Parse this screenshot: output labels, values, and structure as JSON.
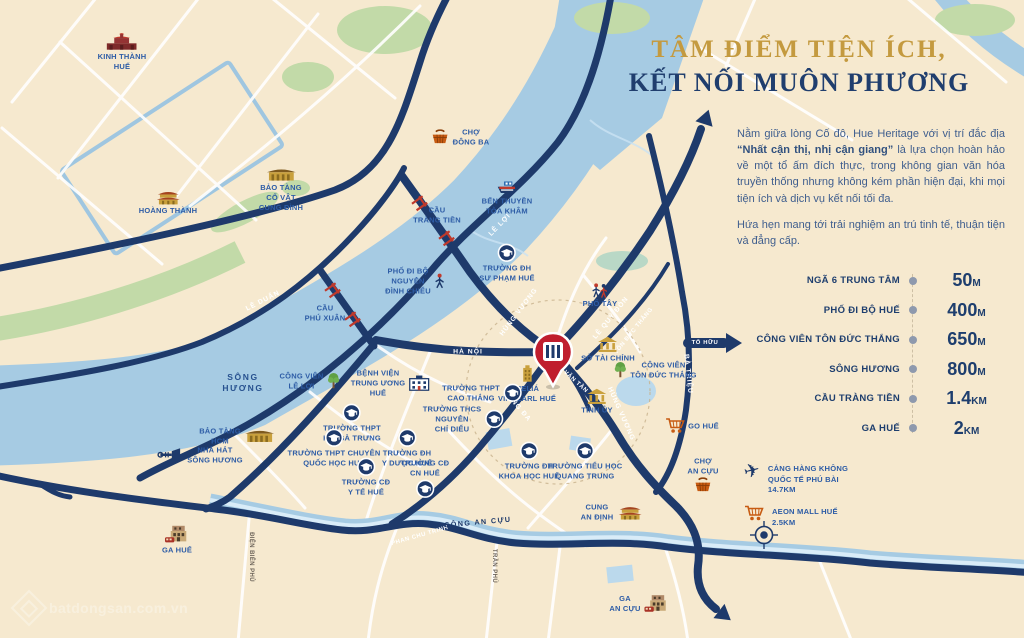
{
  "colors": {
    "background": "#F6E9CF",
    "navy": "#1E3A6B",
    "gold": "#C49A3F",
    "poi_blue": "#2D5CA6",
    "river_blue": "#A6CBE3",
    "green": "#C2DAA8",
    "pin_red": "#C01E2E",
    "orange": "#C75B12"
  },
  "header": {
    "line1": "TÂM ĐIỂM TIỆN ÍCH,",
    "line2": "KẾT NỐI MUÔN PHƯƠNG"
  },
  "intro": {
    "p1_pre": "Nằm giữa lòng Cố đô, Hue Heritage với vị trí đắc địa ",
    "p1_bold": "“Nhất cận thị, nhị cận giang”",
    "p1_post": " là lựa chọn hoàn hảo về một tổ ấm đích thực, trong không gian văn hóa truyền thống nhưng không kém phần hiện đại, khi mọi tiện ích và dịch vụ kết nối tối đa.",
    "p2": "Hứa hẹn mang tới trải nghiệm an trú tinh tế, thuận tiện và đẳng cấp."
  },
  "distances": [
    {
      "label": "NGÃ 6 TRUNG TÂM",
      "value": "50",
      "unit": "M"
    },
    {
      "label": "PHỐ ĐI BỘ HUẾ",
      "value": "400",
      "unit": "M"
    },
    {
      "label": "CÔNG VIÊN TÔN ĐỨC THẮNG",
      "value": "650",
      "unit": "M"
    },
    {
      "label": "SÔNG HƯƠNG",
      "value": "800",
      "unit": "M"
    },
    {
      "label": "CẦU TRÀNG TIỀN",
      "value": "1.4",
      "unit": "KM"
    },
    {
      "label": "GA HUẾ",
      "value": "2",
      "unit": "KM"
    }
  ],
  "legend": [
    {
      "icon": "plane-icon",
      "text": "CẢNG HÀNG KHÔNG\nQUỐC TẾ PHÚ BÀI\n14.7KM"
    },
    {
      "icon": "cart-icon",
      "text": "AEON MALL HUẾ\n2.5KM"
    }
  ],
  "map": {
    "pin": {
      "x": 553,
      "y": 395
    },
    "pois": [
      {
        "id": "kinh-thanh-hue",
        "label": "KINH THÀNH\nHUẾ",
        "icon": "citadel-gate-icon",
        "x": 122,
        "y": 52,
        "side": "top"
      },
      {
        "id": "hoang-thanh",
        "label": "HOÀNG THÀNH",
        "icon": "palace-icon",
        "x": 168,
        "y": 202,
        "side": "top"
      },
      {
        "id": "bao-tang-co-vat-cung-dinh",
        "label": "BẢO TÀNG\nCỔ VẬT\nCUNG ĐÌNH",
        "icon": "museum-icon",
        "x": 281,
        "y": 190,
        "side": "top"
      },
      {
        "id": "cho-dong-ba",
        "label": "CHỢ\nĐÔNG BA",
        "icon": "market-basket-icon",
        "x": 460,
        "y": 137,
        "side": "left"
      },
      {
        "id": "ben-thuyen-toa-kham",
        "label": "BẾN THUYỀN\nTÒA KHÂM",
        "icon": "boat-icon",
        "x": 507,
        "y": 198,
        "side": "top"
      },
      {
        "id": "cau-trang-tien",
        "label": "CẦU\nTRÀNG TIỀN",
        "icon": "",
        "x": 437,
        "y": 215,
        "side": "top"
      },
      {
        "id": "pho-di-bo-nguyen-dinh-chieu",
        "label": "PHỐ ĐI BỘ\nNGUYỄN\nĐÌNH CHIỂU",
        "icon": "walking-person-icon",
        "x": 415,
        "y": 281,
        "side": "right"
      },
      {
        "id": "truong-dh-su-pham-hue",
        "label": "TRƯỜNG ĐH\nSƯ PHẠM HUẾ",
        "icon": "school-icon",
        "x": 507,
        "y": 263,
        "side": "top"
      },
      {
        "id": "pho-tay",
        "label": "PHỐ TÂY",
        "icon": "walking-people-icon",
        "x": 600,
        "y": 296,
        "side": "top"
      },
      {
        "id": "cau-phu-xuan",
        "label": "CẦU\nPHÚ XUÂN",
        "icon": "",
        "x": 325,
        "y": 313,
        "side": "top"
      },
      {
        "id": "song-huong",
        "label": "SÔNG\nHƯƠNG",
        "icon": "",
        "x": 243,
        "y": 383,
        "side": "top",
        "kind": "water-lbl"
      },
      {
        "id": "cong-vien-le-loi",
        "label": "CÔNG VIÊN\nLÊ LỢI",
        "icon": "tree-icon",
        "x": 310,
        "y": 381,
        "side": "right"
      },
      {
        "id": "benh-vien-trung-uong-hue",
        "label": "BỆNH VIỆN\nTRUNG ƯƠNG\nHUẾ",
        "icon": "hospital-icon",
        "x": 390,
        "y": 383,
        "side": "right"
      },
      {
        "id": "melia-vinpearl-hue",
        "label": "MELIÁ\nVINPEARL HUẾ",
        "icon": "gold-building-icon",
        "x": 527,
        "y": 384,
        "side": "top"
      },
      {
        "id": "so-tai-chinh",
        "label": "SỞ TÀI CHÍNH",
        "icon": "govt-building-icon",
        "x": 608,
        "y": 350,
        "side": "top"
      },
      {
        "id": "cong-vien-ton-duc-thang",
        "label": "CÔNG VIÊN\nTÔN ĐỨC THẮNG",
        "icon": "tree-icon",
        "x": 655,
        "y": 370,
        "side": "left"
      },
      {
        "id": "tinh-uy",
        "label": "TỈNH ỦY",
        "icon": "govt-building-icon",
        "x": 597,
        "y": 402,
        "side": "top"
      },
      {
        "id": "truong-thpt-cao-thang",
        "label": "TRƯỜNG THPT\nCAO THẮNG",
        "icon": "school-icon",
        "x": 482,
        "y": 393,
        "side": "right"
      },
      {
        "id": "truong-thcs-nguyen-chi-dieu",
        "label": "TRƯỜNG THCS\nNGUYỄN\nCHÍ DIỂU",
        "icon": "school-icon",
        "x": 463,
        "y": 419,
        "side": "right"
      },
      {
        "id": "truong-thpt-hai-ba-trung",
        "label": "TRƯỜNG THPT\nHAI BÀ TRƯNG",
        "icon": "school-icon",
        "x": 352,
        "y": 423,
        "side": "top"
      },
      {
        "id": "truong-thpt-chuyen-quoc-hoc-hue",
        "label": "TRƯỜNG THPT CHUYÊN\nQUỐC HỌC HUẾ",
        "icon": "school-icon",
        "x": 334,
        "y": 448,
        "side": "top"
      },
      {
        "id": "truong-cd-y-te-hue",
        "label": "TRƯỜNG CĐ\nY TẾ HUẾ",
        "icon": "school-icon",
        "x": 366,
        "y": 477,
        "side": "top"
      },
      {
        "id": "truong-dh-y-duoc-hue",
        "label": "TRƯỜNG ĐH\nY DƯỢC HUẾ",
        "icon": "school-icon",
        "x": 407,
        "y": 448,
        "side": "top"
      },
      {
        "id": "truong-cd-cn-hue",
        "label": "TRƯỜNG CĐ\nCN HUẾ",
        "icon": "school-icon",
        "x": 425,
        "y": 478,
        "side": "bottom"
      },
      {
        "id": "truong-dh-khoa-hoc-hue",
        "label": "TRƯỜNG ĐH\nKHOA HỌC HUẾ",
        "icon": "school-icon",
        "x": 529,
        "y": 461,
        "side": "top"
      },
      {
        "id": "truong-tieu-hoc-quang-trung",
        "label": "TRƯỜNG TIỂU HỌC\nQUANG TRUNG",
        "icon": "school-icon",
        "x": 585,
        "y": 461,
        "side": "top"
      },
      {
        "id": "go-hue",
        "label": "GO HUẾ",
        "icon": "cart-icon",
        "x": 692,
        "y": 426,
        "side": "left"
      },
      {
        "id": "cho-an-cuu",
        "label": "CHỢ\nAN CỰU",
        "icon": "market-basket-icon",
        "x": 703,
        "y": 474,
        "side": "bottom"
      },
      {
        "id": "cung-an-dinh",
        "label": "CUNG\nAN ĐỊNH",
        "icon": "palace-icon",
        "x": 612,
        "y": 512,
        "side": "right"
      },
      {
        "id": "ga-hue",
        "label": "GA HUẾ",
        "icon": "train-station-icon",
        "x": 177,
        "y": 540,
        "side": "top"
      },
      {
        "id": "nha-hat-song-huong",
        "label": "NHÀ HÁT\nSÔNG HƯƠNG",
        "icon": "trumpet-icon",
        "x": 200,
        "y": 455,
        "side": "left"
      },
      {
        "id": "bao-tang-hcm",
        "label": "BẢO TÀNG\nHCM",
        "icon": "museum-icon",
        "x": 237,
        "y": 436,
        "side": "right"
      },
      {
        "id": "ga-an-cuu",
        "label": "GA\nAN CỰU",
        "icon": "train-station-icon",
        "x": 640,
        "y": 604,
        "side": "right"
      }
    ],
    "road_labels": [
      {
        "text": "LÊ DUẨN",
        "x": 263,
        "y": 301,
        "angle": -27,
        "kind": "road"
      },
      {
        "text": "LÊ LỢI",
        "x": 500,
        "y": 225,
        "angle": -46,
        "kind": "road"
      },
      {
        "text": "HÀ NỘI",
        "x": 468,
        "y": 352,
        "angle": 0,
        "kind": "road"
      },
      {
        "text": "HÙNG VƯƠNG",
        "x": 519,
        "y": 312,
        "angle": -53,
        "kind": "road"
      },
      {
        "text": "LÊ QUÝ ĐÔN",
        "x": 611,
        "y": 318,
        "angle": -51,
        "kind": "road"
      },
      {
        "text": "TÔN ĐỨC THẮNG",
        "x": 634,
        "y": 331,
        "angle": -51,
        "kind": "road-small"
      },
      {
        "text": "VÕ VĂN TẦN",
        "x": 571,
        "y": 378,
        "angle": 42,
        "kind": "road-small"
      },
      {
        "text": "ĐỐNG ĐA",
        "x": 517,
        "y": 406,
        "angle": 50,
        "kind": "road"
      },
      {
        "text": "HÙNG VƯƠNG",
        "x": 621,
        "y": 414,
        "angle": 66,
        "kind": "road"
      },
      {
        "text": "BÀ TRIỆU",
        "x": 688,
        "y": 374,
        "angle": 84,
        "kind": "road"
      },
      {
        "text": "TỐ HỮU",
        "x": 705,
        "y": 343,
        "angle": 0,
        "kind": "road-small"
      },
      {
        "text": "PHAN CHU TRINH",
        "x": 420,
        "y": 536,
        "angle": -16,
        "kind": "road-small"
      },
      {
        "text": "SÔNG AN CỰU",
        "x": 478,
        "y": 522,
        "angle": -5,
        "kind": "water"
      },
      {
        "text": "ĐIỆN BIÊN PHỦ",
        "x": 251,
        "y": 557,
        "angle": 90,
        "kind": "minor"
      },
      {
        "text": "TRẦN PHÚ",
        "x": 494,
        "y": 566,
        "angle": 90,
        "kind": "minor"
      }
    ]
  },
  "watermark": {
    "text": "batdongsan.com.vn"
  }
}
